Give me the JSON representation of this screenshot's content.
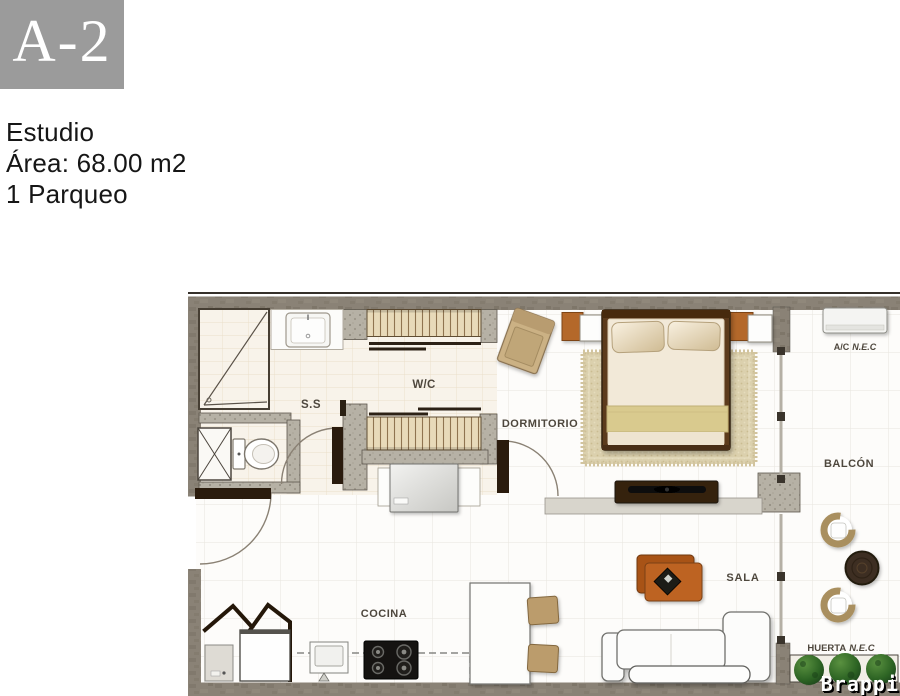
{
  "unit": {
    "code": "A-2"
  },
  "details": {
    "type": "Estudio",
    "area": "Área: 68.00 m2",
    "parking": "1 Parqueo"
  },
  "plan": {
    "rooms": {
      "bathroom": "S.S",
      "closet": "W/C",
      "bedroom": "DORMITORIO",
      "balcony": "BALCÓN",
      "living": "SALA",
      "kitchen": "COCINA"
    },
    "annotations": {
      "ac": {
        "label": "A/C",
        "suffix": "N.E.C"
      },
      "garden": {
        "label": "HUERTA",
        "suffix": "N.E.C"
      }
    }
  },
  "watermark": "Brappi",
  "colors": {
    "badge_gray": "#9b9b9b",
    "wall_gray": "#8a8276",
    "column_gray": "#b6b1a5",
    "closet_tan": "#e8dab9",
    "wood_brown": "#b25a1d",
    "bed_frame": "#5c3b1e",
    "blanket_gold": "#d9ca8e",
    "bush_green": "#2c6323",
    "label_text": "#4e473d"
  }
}
